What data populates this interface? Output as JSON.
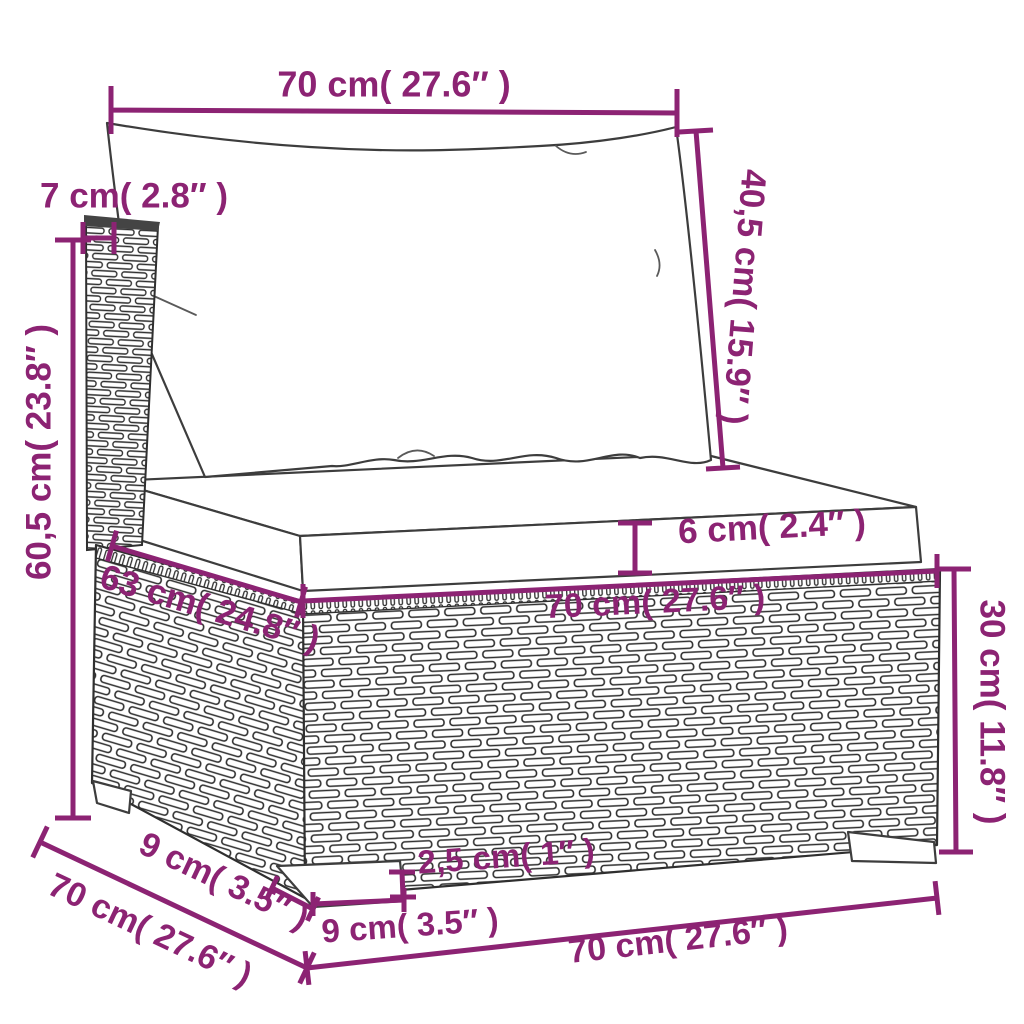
{
  "diagram": {
    "subject": "rattan garden sofa middle section with back and seat cushions, annotated dimension drawing",
    "colors": {
      "dimension": "#8c2373",
      "outline": "#3d3d3d",
      "wicker": "#2f2f2f",
      "background": "#ffffff"
    },
    "dimensions": {
      "back_width": "70 cm( 27.6″ )",
      "back_thickness": "7 cm( 2.8″ )",
      "back_cushion_height": "40,5 cm( 15.9″ )",
      "total_height": "60,5 cm( 23.8″ )",
      "seat_cushion_thickness": "6 cm( 2.4″ )",
      "seat_depth": "63 cm( 24.8″ )",
      "seat_width": "70 cm( 27.6″ )",
      "base_height": "30 cm( 11.8″ )",
      "leg_inset_depth": "9 cm( 3.5″ )",
      "overall_depth": "70 cm( 27.6″ )",
      "leg_height": "2,5 cm( 1″ )",
      "leg_width": "9 cm( 3.5″ )",
      "overall_width": "70 cm( 27.6″ )"
    }
  }
}
